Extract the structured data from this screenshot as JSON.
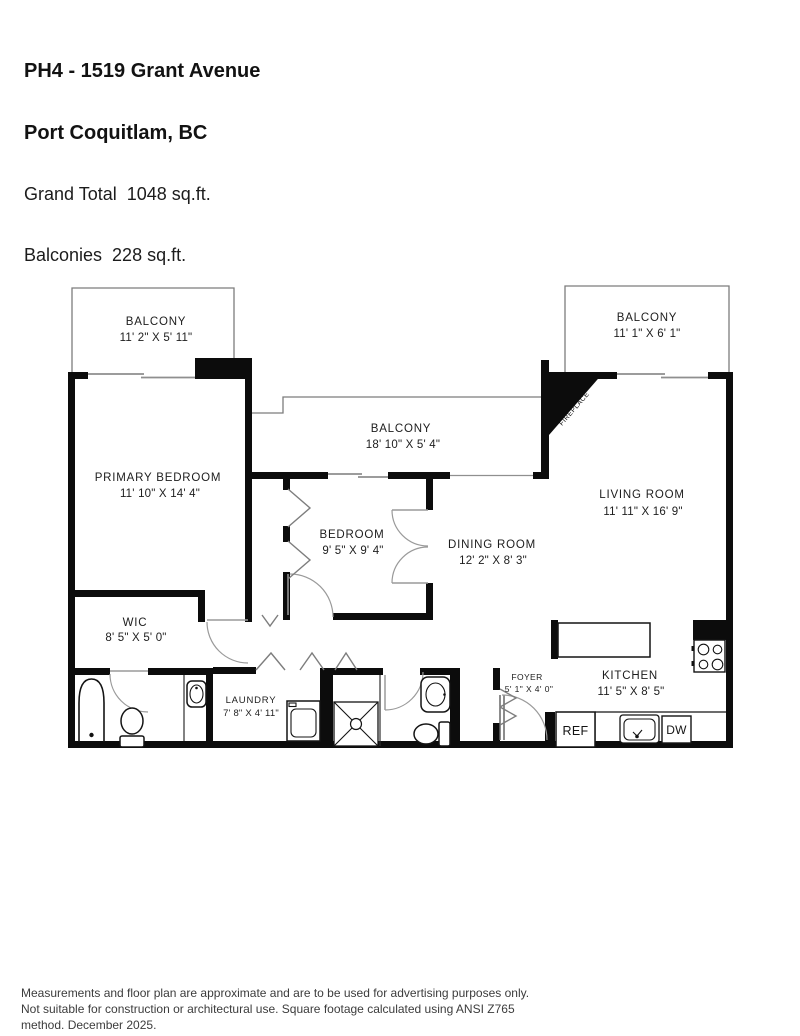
{
  "header": {
    "address_line1": "PH4 - 1519 Grant Avenue",
    "address_line2": "Port Coquitlam, BC",
    "grand_total": "Grand Total  1048 sq.ft.",
    "balconies": "Balconies  228 sq.ft."
  },
  "rooms": {
    "balcony_top_left": {
      "name": "BALCONY",
      "dims": "11' 2\" X 5' 11\""
    },
    "balcony_top_right": {
      "name": "BALCONY",
      "dims": "11' 1\" X 6' 1\""
    },
    "balcony_center": {
      "name": "BALCONY",
      "dims": "18' 10\" X 5' 4\""
    },
    "primary_bedroom": {
      "name": "PRIMARY BEDROOM",
      "dims": "11' 10\" X 14' 4\""
    },
    "living_room": {
      "name": "LIVING ROOM",
      "dims": "11' 11\" X 16' 9\""
    },
    "bedroom": {
      "name": "BEDROOM",
      "dims": "9' 5\" X 9' 4\""
    },
    "dining_room": {
      "name": "DINING ROOM",
      "dims": "12' 2\" X 8' 3\""
    },
    "wic": {
      "name": "WIC",
      "dims": "8' 5\" X 5' 0\""
    },
    "laundry": {
      "name": "LAUNDRY",
      "dims": "7' 8\" X 4' 11\""
    },
    "foyer": {
      "name": "FOYER",
      "dims": "5' 1\" X 4' 0\""
    },
    "kitchen": {
      "name": "KITCHEN",
      "dims": "11' 5\" X 8' 5\""
    }
  },
  "labels": {
    "fireplace": "FIREPLACE",
    "ref": "REF",
    "dw": "DW"
  },
  "footer": {
    "disclaimer": "Measurements and floor plan are approximate and are to be used for advertising purposes only. Not suitable for construction or architectural use. Square footage calculated using ANSI Z765 method. December 2025."
  }
}
